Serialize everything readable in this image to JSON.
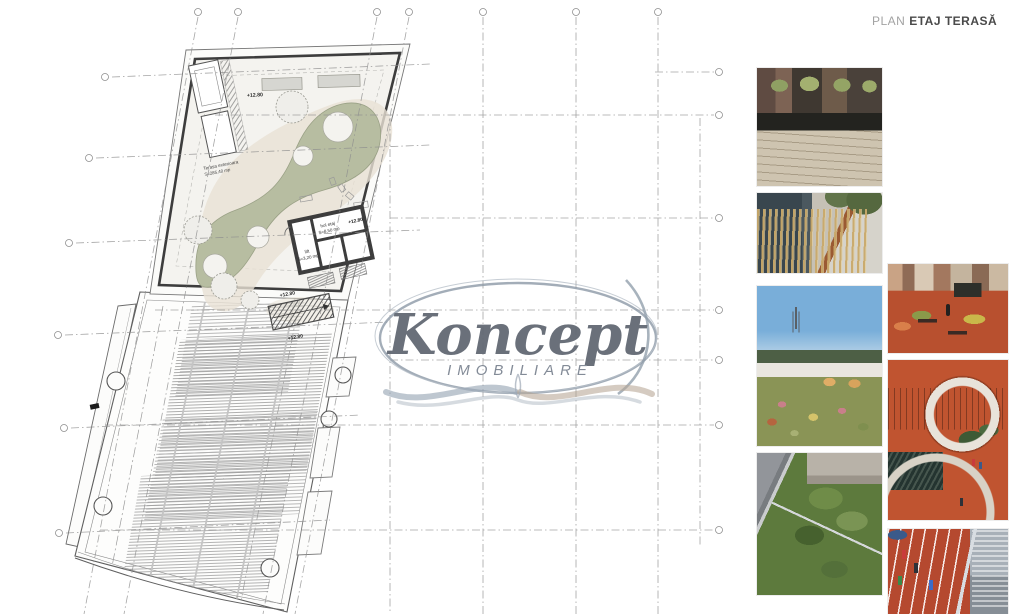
{
  "header": {
    "label_light": "PLAN",
    "label_bold": "ETAJ TERASĂ"
  },
  "watermark": {
    "brand": "Koncept",
    "subtitle": "IMOBILIARE"
  },
  "plan": {
    "elevation_mark": "+12.80",
    "terrace_label_1": "Terasa exterioara",
    "terrace_label_2": "S=285,40 mp",
    "core_room_1": "hol etaj",
    "core_room_1_area": "S=8,50 mp",
    "core_room_2": "lift",
    "core_room_2_area": "S=3,20 mp",
    "colors": {
      "green": "#b7bda1",
      "beige": "#e8e1d4",
      "wall": "#3d3d3d",
      "outline": "#5f5f5f",
      "grid": "#8f8f8f",
      "hatch": "#b0b0b0"
    }
  },
  "photos": [
    {
      "id": "photo-1",
      "subject": "rooftop wooden deck with black planters and city skyline"
    },
    {
      "id": "photo-2",
      "subject": "ornamental grasses with corten steel planters"
    },
    {
      "id": "photo-3",
      "subject": "wildflower green roof with lounge chairs and tower view"
    },
    {
      "id": "photo-4",
      "subject": "intensive green roof edge above courtyard"
    },
    {
      "id": "photo-5",
      "subject": "red rooftop terrace with benches and planting"
    },
    {
      "id": "photo-6",
      "subject": "curved orange rooftop playground ramp"
    },
    {
      "id": "photo-7",
      "subject": "rooftop running track with runners"
    }
  ]
}
